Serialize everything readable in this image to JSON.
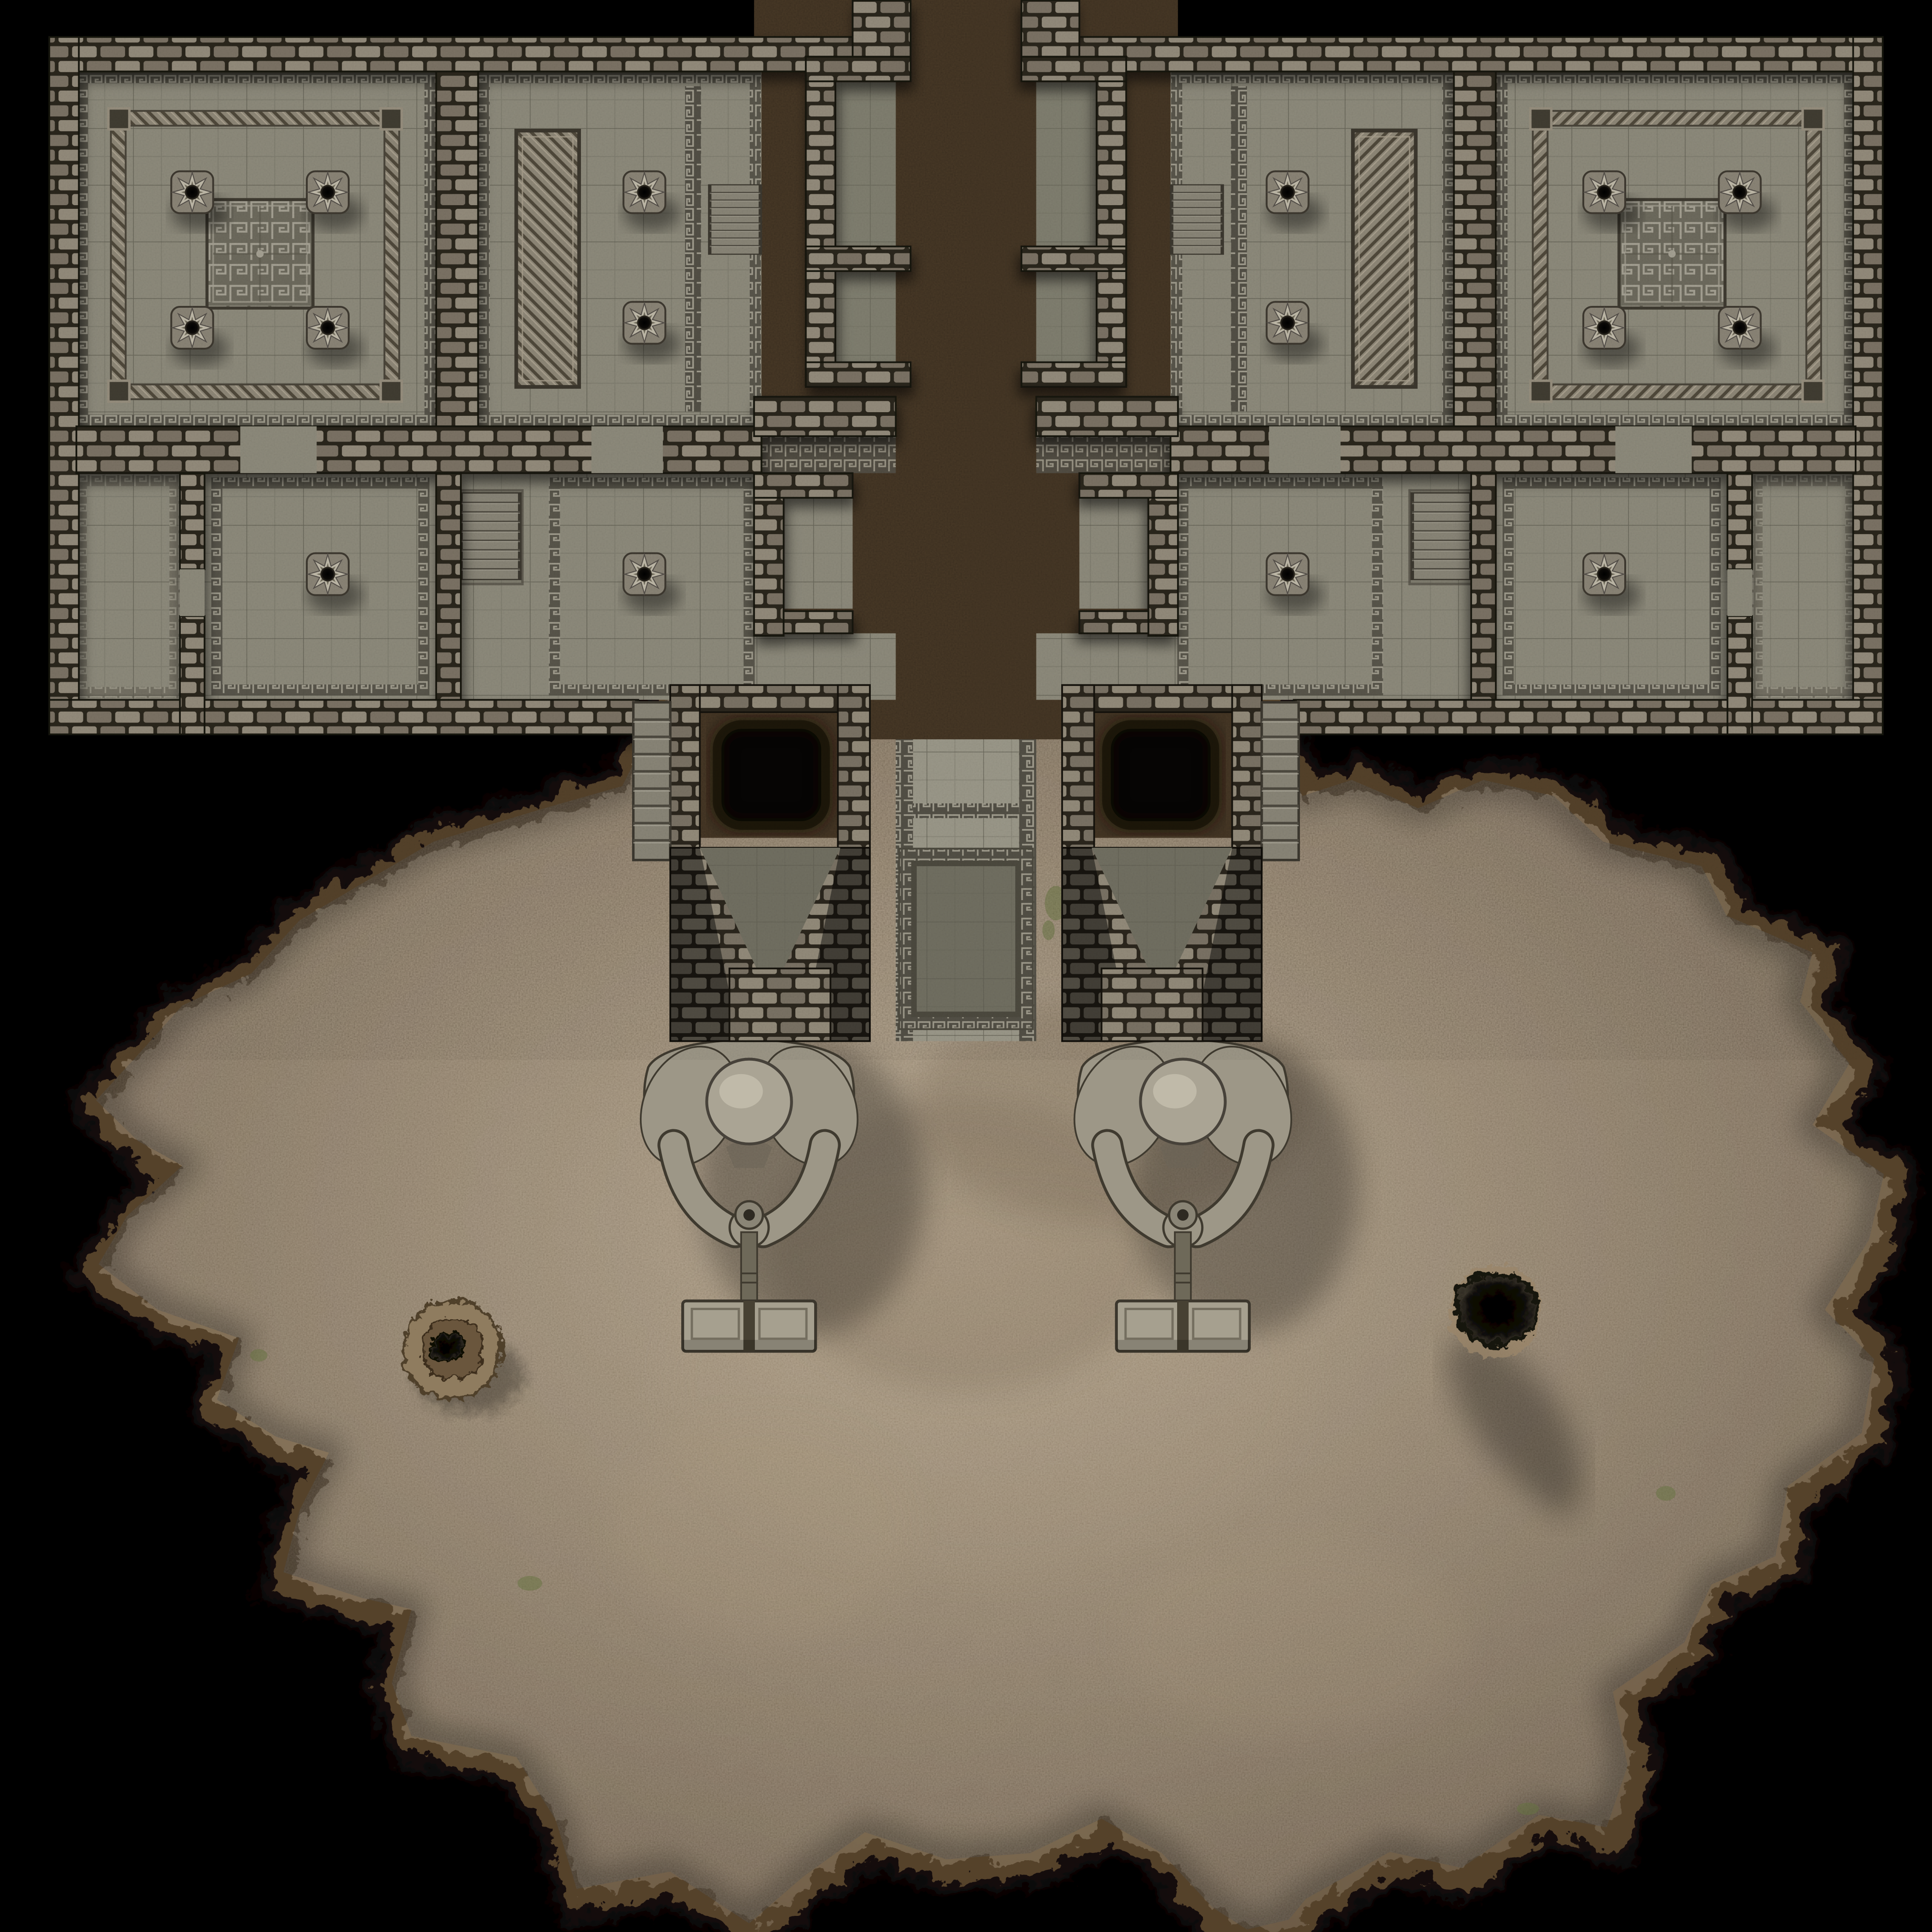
{
  "scene": {
    "type": "tabletop-battle-map",
    "description": "Top-down fantasy dungeon map: symmetric stone temple complex with tiled halls, greek-key ornament, labyrinth mosaics, twin gate pits and two giant kneeling statues holding hammers, opening onto a large irregular earthen cavern",
    "orientation": "top-down",
    "visible_text": ""
  },
  "counts": {
    "rooms": 12,
    "ornate_pillars": 16,
    "staircases": 6,
    "gate_pits": 2,
    "statues": 2,
    "labyrinth_mosaics": 2,
    "carved_braid_panels": 2,
    "cave_holes": 2
  },
  "legend": {
    "rooms": [
      {
        "name": "west pillared hall",
        "features": [
          "four ornate pillars",
          "labyrinth mosaic",
          "braided border inlay"
        ]
      },
      {
        "name": "west panel room",
        "features": [
          "carved braid panel",
          "two pillars",
          "stairs to corridor"
        ]
      },
      {
        "name": "central processional corridor",
        "features": [
          "greek-key edged walkway",
          "side niches",
          "sunken ramp"
        ]
      },
      {
        "name": "east panel room",
        "features": [
          "carved braid panel",
          "two pillars",
          "stairs to corridor"
        ]
      },
      {
        "name": "east pillared hall",
        "features": [
          "four ornate pillars",
          "labyrinth mosaic",
          "braided border inlay"
        ]
      },
      {
        "name": "lower chambers",
        "features": [
          "greek-key bordered rooms",
          "single pillars",
          "sunken stairs"
        ]
      },
      {
        "name": "gate house",
        "features": [
          "two black pits",
          "funnel walls",
          "outer stairs"
        ]
      },
      {
        "name": "cavern",
        "features": [
          "dirt floor",
          "rocky rim",
          "stone mound with vent",
          "dark floor hole",
          "moss patches"
        ]
      }
    ],
    "statues": {
      "description": "kneeling giant gripping a great maul, head bowed, maul head resting on ground",
      "count": 2
    }
  },
  "colors": {
    "bg": "#000000",
    "floor": "#8e8b7c",
    "floorLight": "#9c998a",
    "floorDark": "#727062",
    "gridline": "#4e4c42",
    "wallLight": "#948c7b",
    "wallMid": "#7b7365",
    "mortar": "#2b261d",
    "keyBg": "#535046",
    "keyLine": "#a39f90",
    "mazeBg": "#6e6b5e",
    "mazeLine": "#a6a294",
    "braidBg": "#8f8878",
    "braidLine": "#50493b",
    "braidLite": "#b0a895",
    "rockMid": "#4a3a27",
    "rockDark": "#2a1f12",
    "rockLight": "#7a6349",
    "dirtLight": "#b2a084",
    "dirtMid": "#8f7c62",
    "dirtDark": "#62513c",
    "rimRock": "#55422c",
    "rimDark": "#170f08",
    "statueBase": "#9d9787",
    "statueShade": "#6b6557",
    "statueLight": "#d2ccba",
    "statueLine": "#3f3a2f",
    "pitBlack": "#060504",
    "moss": "#66743f"
  }
}
